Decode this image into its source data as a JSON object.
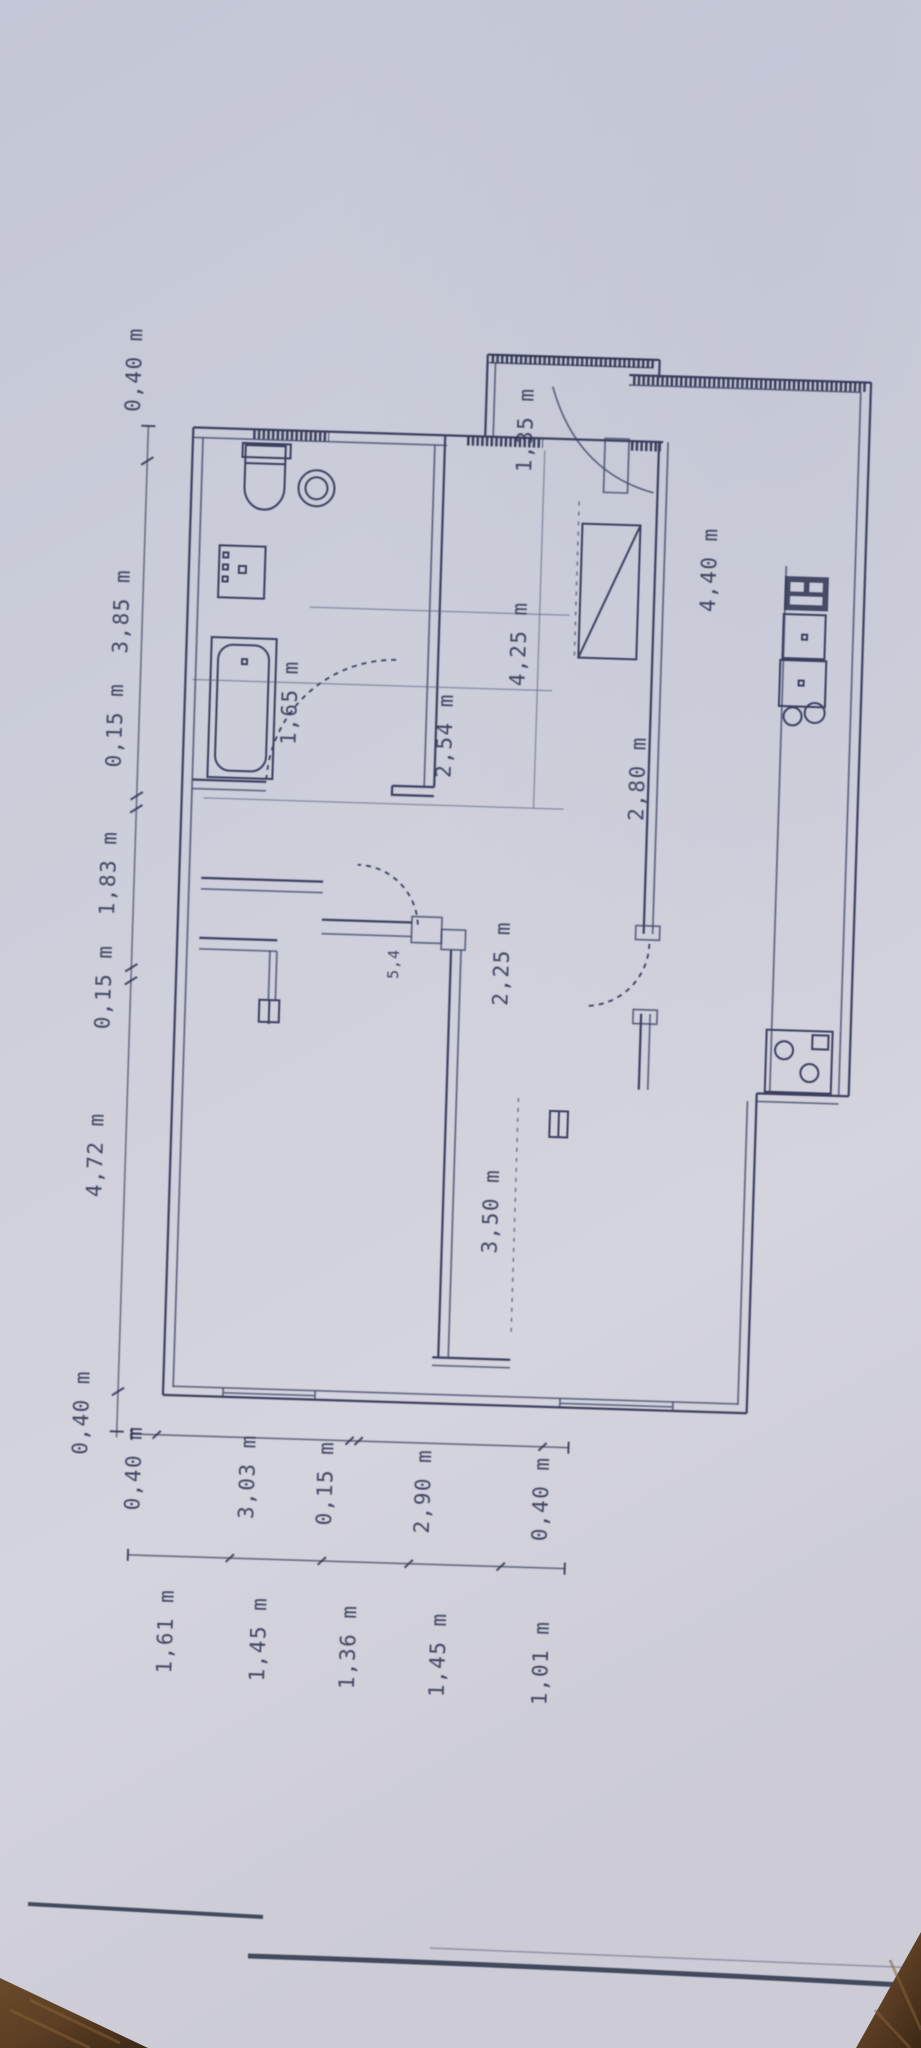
{
  "document_type": "floor-plan-photo",
  "units": "m",
  "colors": {
    "paper": "#cbcdda",
    "ink": "#343a58",
    "wood": "#5d3f24"
  },
  "dims": {
    "left": [
      "0,40 m",
      "3,85 m",
      "0,15 m",
      "1,83 m",
      "0,15 m",
      "4,72 m",
      "0,40 m"
    ],
    "bottom_outer": [
      "0,40 m",
      "3,03 m",
      "0,15 m",
      "2,90 m",
      "0,40 m"
    ],
    "bottom_inner": [
      "1,61 m",
      "1,45 m",
      "1,36 m",
      "1,45 m",
      "1,01 m"
    ],
    "interior": {
      "entry_width": "1,35 m",
      "hall_length": "4,25 m",
      "hall_width": "2,54 m",
      "bath_door": "1,65 m",
      "kitchen_length": "4,40 m",
      "kitchen_width": "2,80 m",
      "corridor_width": "2,25 m",
      "room_width": "3,50 m",
      "door_note": "5,4"
    }
  },
  "fixtures": [
    "toilet",
    "wash-basin",
    "washing-machine",
    "bathtub",
    "wardrobe",
    "kitchen-counter",
    "kitchen-sink",
    "stove",
    "radiator",
    "door-swing"
  ]
}
